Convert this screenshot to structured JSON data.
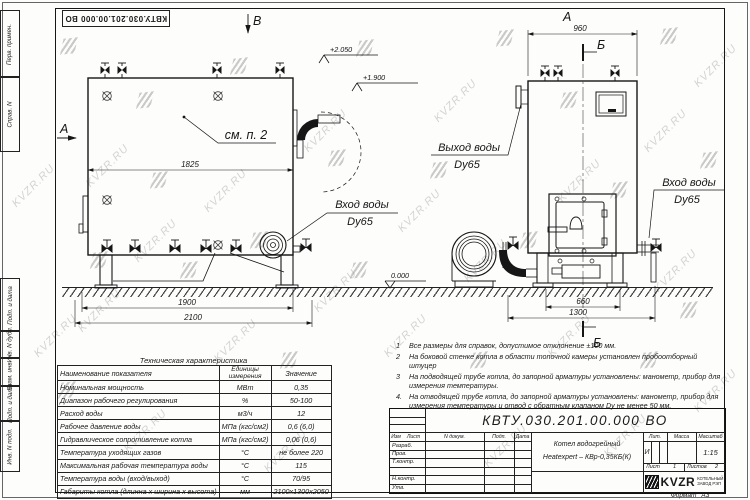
{
  "sheet": {
    "stamp_number": "КВТУ.030.201.00.000  ВО"
  },
  "watermark": {
    "t": "KVZR.RU"
  },
  "margin": {
    "labels": [
      "Перв. примен.",
      "Справ. N",
      "Подп. и дата",
      "Инв. N дубл.",
      "Взам. инв. N",
      "Подп. и дата",
      "Инв. N подл."
    ]
  },
  "views": {
    "left": {
      "view_a": "А",
      "view_b": "В",
      "see_note": "см. п. 2",
      "dim_inner": "1825",
      "dim_base": "1900",
      "dim_total": "2100",
      "elev_top": "+2.050",
      "elev_pipe": "+1.900",
      "elev_zero": "0.000",
      "inlet_line1": "Вход воды",
      "inlet_line2": "Dy65"
    },
    "right": {
      "view_label": "А",
      "section": "Б",
      "dim_top": "960",
      "dim_base": "660",
      "dim_total": "1300",
      "outlet_line1": "Выход воды",
      "outlet_line2": "Dy65",
      "inlet_line1": "Вход воды",
      "inlet_line2": "Dy65"
    }
  },
  "notes": [
    {
      "n": "1",
      "t": "Все размеры для справок, допустимое отклонение ±100 мм."
    },
    {
      "n": "2",
      "t": "На боковой стенке котла в области топочной камеры установлен пробоотборный штуцер"
    },
    {
      "n": "3",
      "t": "На подводящей трубе котла, до запорной арматуры установлены: манометр, прибор для измерения температуры."
    },
    {
      "n": "4.",
      "t": "На отводящей трубе котла, до запорной арматуры установлены: манометр, прибор для измерения температуры и отвод с обратным клапаном Dу не менее 50 мм."
    }
  ],
  "tech": {
    "title": "Техническая характеристика",
    "h_name": "Наименование показателя",
    "h_unit1": "Единицы",
    "h_unit2": "измерения",
    "h_value": "Значение",
    "rows": [
      {
        "n": "Номинальная мощность",
        "u": "МВт",
        "v": "0,35"
      },
      {
        "n": "Диапазон рабочего регулирования",
        "u": "%",
        "v": "50-100"
      },
      {
        "n": "Расход воды",
        "u": "м3/ч",
        "v": "12"
      },
      {
        "n": "Рабочее давление воды",
        "u": "МПа (кгс/см2)",
        "v": "0,6 (6,0)"
      },
      {
        "n": "Гидравлическое сопротивление котла",
        "u": "МПа (кгс/см2)",
        "v": "0,06 (0,6)"
      },
      {
        "n": "Температура уходящих газов",
        "u": "°С",
        "v": "не более 220"
      },
      {
        "n": "Максимальная рабочая температура воды",
        "u": "°С",
        "v": "115"
      },
      {
        "n": "Температура воды (вход/выход)",
        "u": "°С",
        "v": "70/95"
      },
      {
        "n": "Габариты котла (длинна х ширина х высота)",
        "u": "мм",
        "v": "2100х1300х2050"
      }
    ]
  },
  "tb": {
    "number": "КВТУ.030.201.00.000  ВО",
    "c_izm": "Изм",
    "c_list": "Лист",
    "c_doc": "N докум.",
    "c_podp": "Подп.",
    "c_data": "Дата",
    "r1": "Разраб.",
    "r2": "Пров.",
    "r3": "Т.контр.",
    "r4": "Н.контр.",
    "r5": "Утв.",
    "name1": "Котел водогрейный",
    "name2": "Heatexpert – КВр-0,35КБ(К)",
    "lit": "Лит.",
    "mass": "Масса",
    "scale": "Масштаб",
    "lit_v": "И",
    "scale_v": "1:15",
    "sheet": "Лист",
    "sheet_v": "1",
    "sheets": "Листов",
    "sheets_v": "2",
    "brand": "KVZR",
    "brand1": "КОТЕЛЬНЫЙ",
    "brand2": "ЗАВОД РЭП",
    "format_label": "Формат",
    "format_v": "А3"
  }
}
